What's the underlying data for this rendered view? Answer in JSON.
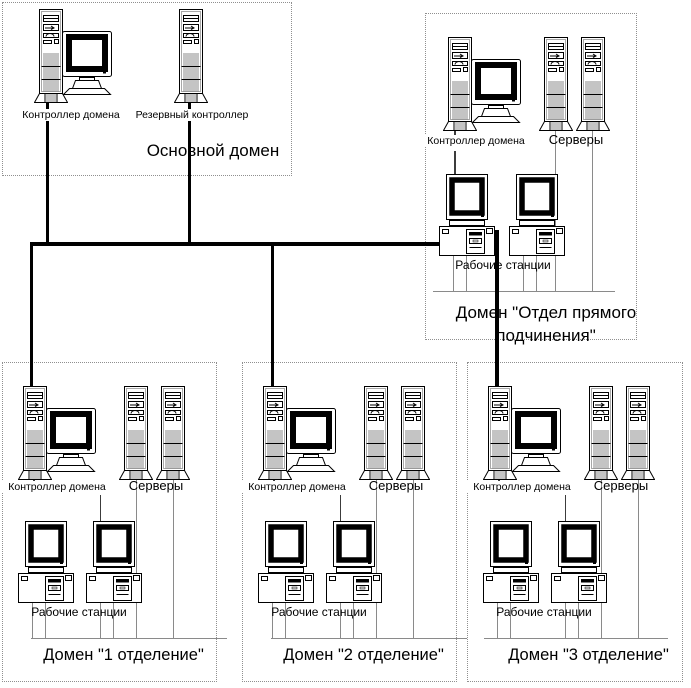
{
  "diagram": {
    "background_color": "#ffffff",
    "line_color": "#000000",
    "thin_line_color": "#8a8a8a",
    "box_border_color": "#8f8f8f",
    "icons": {
      "tower": "server-tower-icon",
      "controller": "desktop-computer-icon",
      "workstation": "workstation-icon"
    },
    "main_domain": {
      "title": "Основной домен",
      "controller_label": "Контроллер домена",
      "backup_label": "Резервный контроллер"
    },
    "dept_domain": {
      "title_line1": "Домен \"Отдел прямого",
      "title_line2": "подчинения\"",
      "controller_label": "Контроллер домена",
      "servers_label": "Серверы",
      "workstations_label": "Рабочие станции"
    },
    "branch_domains": [
      {
        "title": "Домен \"1 отделение\"",
        "controller_label": "Контроллер домена",
        "servers_label": "Серверы",
        "workstations_label": "Рабочие станции"
      },
      {
        "title": "Домен \"2 отделение\"",
        "controller_label": "Контроллер домена",
        "servers_label": "Серверы",
        "workstations_label": "Рабочие станции"
      },
      {
        "title": "Домен \"3 отделение\"",
        "controller_label": "Контроллер домена",
        "servers_label": "Серверы",
        "workstations_label": "Рабочие станции"
      }
    ]
  }
}
